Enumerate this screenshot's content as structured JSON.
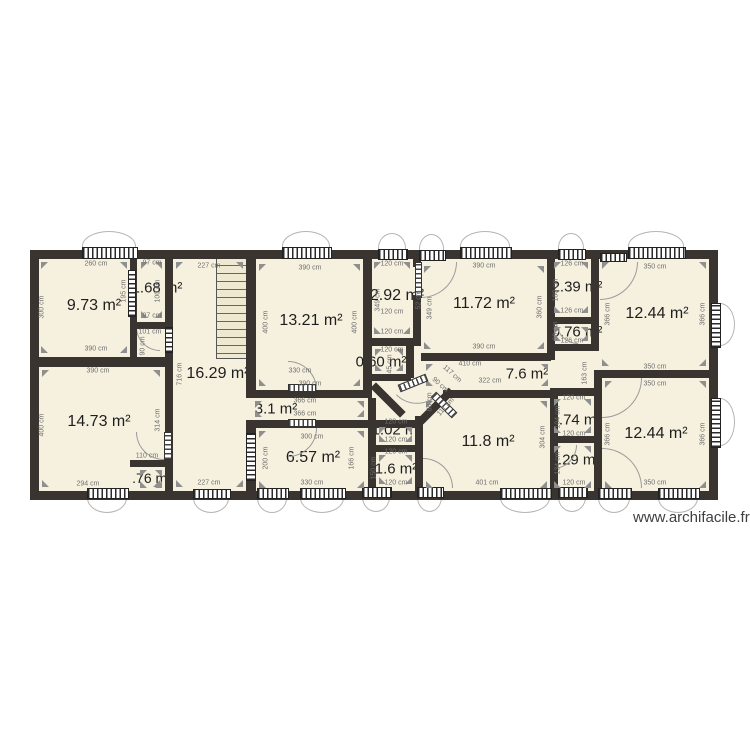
{
  "watermark": "www.archifacile.fr",
  "colors": {
    "wall": "#39342f",
    "floor": "#f6f1df",
    "dim_text": "#6e6e6e",
    "label_text": "#1e1e1e",
    "arc_line": "#9a9a9a",
    "arrow": "#8f8f8f",
    "watermark_text": "#3f3f3f"
  },
  "plan": {
    "floor": [
      34,
      254,
      682,
      242
    ],
    "stairs": [
      216,
      257,
      32,
      100
    ],
    "rooms": [
      {
        "label": "9.73 m²",
        "cx": 94,
        "cy": 306,
        "fs": 16,
        "rect": [
          40,
          261,
          88,
          93
        ]
      },
      {
        "label": "1.68 m²",
        "cx": 157,
        "cy": 288,
        "fs": 15,
        "rect": [
          140,
          261,
          23,
          58
        ]
      },
      {
        "label": "16.29 m²",
        "cx": 218,
        "cy": 374,
        "fs": 16,
        "rect": [
          175,
          261,
          69,
          227
        ]
      },
      {
        "label": "13.21 m²",
        "cx": 311,
        "cy": 321,
        "fs": 16,
        "rect": [
          258,
          263,
          103,
          124
        ]
      },
      {
        "label": "2.92 m²",
        "cx": 397,
        "cy": 296,
        "fs": 16,
        "rect": [
          373,
          261,
          38,
          74
        ]
      },
      {
        "label": "11.72 m²",
        "cx": 484,
        "cy": 304,
        "fs": 16,
        "rect": [
          423,
          265,
          122,
          85
        ]
      },
      {
        "label": "2.39 m²",
        "cx": 577,
        "cy": 287,
        "fs": 15,
        "rect": [
          553,
          261,
          36,
          53
        ]
      },
      {
        "label": "12.44 m²",
        "cx": 657,
        "cy": 314,
        "fs": 16,
        "rect": [
          601,
          261,
          106,
          106
        ]
      },
      {
        "label": "0.76 m²",
        "cx": 577,
        "cy": 332,
        "fs": 15,
        "rect": [
          553,
          326,
          36,
          16
        ]
      },
      {
        "label": "0.60 m²",
        "cx": 381,
        "cy": 362,
        "fs": 15,
        "rect": [
          374,
          348,
          30,
          24
        ]
      },
      {
        "label": "7.6 m²",
        "cx": 527,
        "cy": 374,
        "fs": 15,
        "rect": [
          425,
          363,
          124,
          24
        ]
      },
      {
        "label": "14.73 m²",
        "cx": 99,
        "cy": 422,
        "fs": 16,
        "rect": [
          41,
          369,
          120,
          119
        ]
      },
      {
        "label": "3.1 m²",
        "cx": 276,
        "cy": 409,
        "fs": 15,
        "rect": [
          254,
          400,
          111,
          18
        ]
      },
      {
        "label": "6.57 m²",
        "cx": 313,
        "cy": 458,
        "fs": 16,
        "rect": [
          258,
          430,
          107,
          59
        ]
      },
      {
        "label": "1.02 m²",
        "cx": 397,
        "cy": 430,
        "fs": 15,
        "rect": [
          378,
          426,
          35,
          17
        ]
      },
      {
        "label": "1.6 m²",
        "cx": 396,
        "cy": 469,
        "fs": 15,
        "rect": [
          378,
          454,
          35,
          31
        ]
      },
      {
        "label": "11.8 m²",
        "cx": 488,
        "cy": 442,
        "fs": 16,
        "rect": [
          425,
          400,
          123,
          89
        ]
      },
      {
        "label": "0.74 m²",
        "cx": 576,
        "cy": 420,
        "fs": 15,
        "rect": [
          553,
          398,
          39,
          36
        ]
      },
      {
        "label": "2.29 m²",
        "cx": 575,
        "cy": 460,
        "fs": 15,
        "rect": [
          553,
          445,
          39,
          44
        ]
      },
      {
        "label": "12.44 m²",
        "cx": 656,
        "cy": 434,
        "fs": 16,
        "rect": [
          604,
          380,
          103,
          109
        ]
      },
      {
        "label": ".76 m²",
        "cx": 152,
        "cy": 478,
        "fs": 14,
        "rect": [
          139,
          469,
          24,
          20
        ]
      }
    ],
    "walls": [
      [
        30,
        250,
        688,
        9
      ],
      [
        30,
        491,
        688,
        9
      ],
      [
        30,
        250,
        9,
        250
      ],
      [
        709,
        250,
        9,
        250
      ],
      [
        130,
        255,
        7,
        104
      ],
      [
        165,
        255,
        8,
        72
      ],
      [
        165,
        353,
        8,
        138
      ],
      [
        246,
        255,
        10,
        143
      ],
      [
        246,
        420,
        10,
        71
      ],
      [
        363,
        255,
        9,
        143
      ],
      [
        406,
        346,
        8,
        32
      ],
      [
        413,
        255,
        8,
        12
      ],
      [
        413,
        295,
        8,
        51
      ],
      [
        547,
        255,
        8,
        105
      ],
      [
        591,
        255,
        8,
        96
      ],
      [
        550,
        388,
        8,
        103
      ],
      [
        594,
        370,
        8,
        121
      ],
      [
        368,
        398,
        8,
        93
      ],
      [
        415,
        416,
        8,
        75
      ],
      [
        415,
        420,
        8,
        71
      ],
      [
        130,
        322,
        43,
        7
      ],
      [
        30,
        357,
        143,
        10
      ],
      [
        246,
        390,
        126,
        8
      ],
      [
        246,
        420,
        177,
        8
      ],
      [
        371,
        338,
        50,
        8
      ],
      [
        421,
        353,
        130,
        8
      ],
      [
        551,
        317,
        48,
        7
      ],
      [
        551,
        344,
        48,
        7
      ],
      [
        598,
        370,
        111,
        8
      ],
      [
        550,
        388,
        52,
        8
      ],
      [
        551,
        436,
        51,
        7
      ],
      [
        368,
        445,
        55,
        7
      ],
      [
        130,
        460,
        43,
        7
      ],
      [
        443,
        390,
        109,
        8
      ],
      [
        371,
        374,
        40,
        7
      ]
    ],
    "diag_walls": [
      [
        388,
        400,
        42,
        45
      ],
      [
        436,
        406,
        44,
        -45
      ]
    ],
    "windows": [
      [
        82,
        247,
        56,
        12,
        "h",
        "top"
      ],
      [
        282,
        247,
        50,
        12,
        "h",
        "top"
      ],
      [
        378,
        249,
        30,
        11,
        "h",
        "top"
      ],
      [
        419,
        250,
        27,
        11,
        "h",
        "top"
      ],
      [
        460,
        247,
        52,
        12,
        "h",
        "top"
      ],
      [
        558,
        249,
        28,
        11,
        "h",
        "top"
      ],
      [
        628,
        247,
        58,
        12,
        "h",
        "top"
      ],
      [
        600,
        253,
        27,
        9,
        "h",
        null
      ],
      [
        711,
        303,
        10,
        45,
        "v",
        "right"
      ],
      [
        711,
        398,
        10,
        50,
        "v",
        "right"
      ],
      [
        87,
        488,
        42,
        11,
        "h",
        "bottom"
      ],
      [
        193,
        489,
        38,
        10,
        "h",
        "bottom"
      ],
      [
        257,
        488,
        32,
        11,
        "h",
        "bottom"
      ],
      [
        300,
        488,
        46,
        11,
        "h",
        "bottom"
      ],
      [
        362,
        487,
        30,
        11,
        "h",
        "bottom"
      ],
      [
        417,
        487,
        27,
        11,
        "h",
        "bottom"
      ],
      [
        500,
        488,
        52,
        11,
        "h",
        "bottom"
      ],
      [
        558,
        487,
        30,
        11,
        "h",
        "bottom"
      ],
      [
        598,
        488,
        34,
        11,
        "h",
        "bottom"
      ],
      [
        658,
        488,
        42,
        11,
        "h",
        "bottom"
      ],
      [
        128,
        270,
        8,
        47,
        "v",
        null
      ],
      [
        165,
        327,
        8,
        26,
        "v",
        null
      ],
      [
        246,
        433,
        10,
        48,
        "v",
        null
      ]
    ],
    "door_leaves": [
      [
        415,
        262,
        7,
        36,
        0
      ],
      [
        288,
        384,
        28,
        8,
        0
      ],
      [
        288,
        419,
        28,
        8,
        0
      ],
      [
        164,
        432,
        8,
        28,
        0
      ],
      [
        398,
        379,
        30,
        8,
        -22
      ],
      [
        429,
        401,
        30,
        8,
        45
      ]
    ],
    "door_arcs": [
      [
        136,
        327,
        24,
        "bl",
        0
      ],
      [
        288,
        361,
        29,
        "tr",
        0
      ],
      [
        288,
        428,
        29,
        "br",
        0
      ],
      [
        136,
        432,
        28,
        "bl",
        0
      ],
      [
        421,
        262,
        36,
        "br",
        0
      ],
      [
        600,
        262,
        38,
        "br",
        0
      ],
      [
        556,
        322,
        22,
        "bl",
        0
      ],
      [
        423,
        458,
        30,
        "tr",
        0
      ],
      [
        602,
        378,
        40,
        "br",
        0
      ],
      [
        602,
        448,
        40,
        "tr",
        0
      ],
      [
        553,
        445,
        24,
        "br",
        0
      ],
      [
        402,
        380,
        30,
        "br",
        45
      ]
    ],
    "dims": [
      [
        "260 cm",
        96,
        264,
        0
      ],
      [
        "300 cm",
        42,
        307,
        -90
      ],
      [
        "390 cm",
        96,
        349,
        0
      ],
      [
        "195 cm",
        124,
        291,
        -90
      ],
      [
        "97 cm",
        152,
        263,
        0
      ],
      [
        "100 cm",
        158,
        291,
        -90
      ],
      [
        "97 cm",
        152,
        316,
        0
      ],
      [
        "101 cm",
        150,
        332,
        0
      ],
      [
        "90 cm",
        143,
        346,
        -90
      ],
      [
        "227 cm",
        209,
        266,
        0
      ],
      [
        "716 cm",
        180,
        374,
        -90
      ],
      [
        "227 cm",
        209,
        483,
        0
      ],
      [
        "390 cm",
        310,
        268,
        0
      ],
      [
        "400 cm",
        266,
        322,
        -90
      ],
      [
        "400 cm",
        355,
        322,
        -90
      ],
      [
        "390 cm",
        310,
        384,
        0
      ],
      [
        "120 cm",
        392,
        264,
        0
      ],
      [
        "349 cm",
        378,
        300,
        -90
      ],
      [
        "52 cm",
        419,
        300,
        -90
      ],
      [
        "120 cm",
        392,
        312,
        0
      ],
      [
        "120 cm",
        392,
        332,
        0
      ],
      [
        "45 cm",
        390,
        364,
        -90
      ],
      [
        "390 cm",
        484,
        266,
        0
      ],
      [
        "349 cm",
        430,
        308,
        -90
      ],
      [
        "360 cm",
        540,
        307,
        -90
      ],
      [
        "390 cm",
        484,
        347,
        0
      ],
      [
        "126 cm",
        572,
        264,
        0
      ],
      [
        "180 cm",
        556,
        290,
        -90
      ],
      [
        "126 cm",
        572,
        311,
        0
      ],
      [
        "60 cm",
        556,
        331,
        -90
      ],
      [
        "126 cm",
        572,
        341,
        0
      ],
      [
        "350 cm",
        655,
        267,
        0
      ],
      [
        "366 cm",
        608,
        314,
        -90
      ],
      [
        "366 cm",
        703,
        314,
        -90
      ],
      [
        "350 cm",
        655,
        367,
        0
      ],
      [
        "410 cm",
        470,
        364,
        0
      ],
      [
        "117 cm",
        452,
        374,
        42
      ],
      [
        "90 cm",
        440,
        385,
        42
      ],
      [
        "111 cm",
        446,
        407,
        -48
      ],
      [
        "322 cm",
        490,
        381,
        0
      ],
      [
        "88 cm",
        430,
        402,
        -90
      ],
      [
        "304 cm",
        543,
        437,
        -90
      ],
      [
        "401 cm",
        487,
        483,
        0
      ],
      [
        "120 cm",
        574,
        398,
        0
      ],
      [
        "104 cm",
        558,
        417,
        -90
      ],
      [
        "120 cm",
        574,
        434,
        0
      ],
      [
        "134 cm",
        558,
        463,
        -90
      ],
      [
        "120 cm",
        574,
        483,
        0
      ],
      [
        "163 cm",
        585,
        373,
        -90
      ],
      [
        "350 cm",
        655,
        384,
        0
      ],
      [
        "366 cm",
        608,
        434,
        -90
      ],
      [
        "366 cm",
        703,
        434,
        -90
      ],
      [
        "350 cm",
        655,
        483,
        0
      ],
      [
        "390 cm",
        98,
        371,
        0
      ],
      [
        "400 cm",
        42,
        425,
        -90
      ],
      [
        "314 cm",
        158,
        420,
        -90
      ],
      [
        "110 cm",
        147,
        456,
        0
      ],
      [
        "294 cm",
        88,
        484,
        0
      ],
      [
        "330 cm",
        300,
        371,
        0
      ],
      [
        "366 cm",
        305,
        401,
        0
      ],
      [
        "366 cm",
        305,
        414,
        0
      ],
      [
        "300 cm",
        312,
        437,
        0
      ],
      [
        "200 cm",
        266,
        458,
        -90
      ],
      [
        "166 cm",
        352,
        458,
        -90
      ],
      [
        "330 cm",
        312,
        483,
        0
      ],
      [
        "120 cm",
        396,
        422,
        0
      ],
      [
        "120 cm",
        396,
        440,
        0
      ],
      [
        "120 cm",
        396,
        452,
        0
      ],
      [
        "150 cm",
        374,
        468,
        -90
      ],
      [
        "120 cm",
        396,
        483,
        0
      ],
      [
        "120 cm",
        392,
        350,
        0
      ]
    ]
  }
}
